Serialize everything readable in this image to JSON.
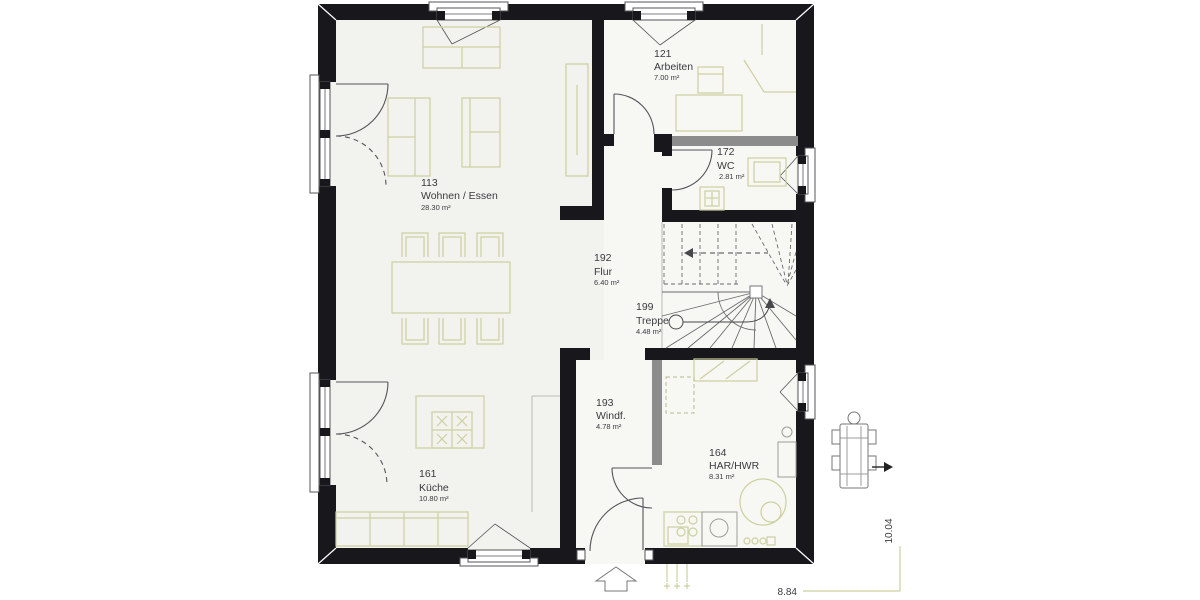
{
  "rooms": [
    {
      "number": "113",
      "name": "Wohnen / Essen",
      "area": "28.30 m²"
    },
    {
      "number": "121",
      "name": "Arbeiten",
      "area": "7.00 m²"
    },
    {
      "number": "172",
      "name": "WC",
      "area": "2.81 m²"
    },
    {
      "number": "192",
      "name": "Flur",
      "area": "6.40 m²"
    },
    {
      "number": "199",
      "name": "Treppe",
      "area": "4.48 m²"
    },
    {
      "number": "193",
      "name": "Windf.",
      "area": "4.78 m²"
    },
    {
      "number": "161",
      "name": "Küche",
      "area": "10.80 m²"
    },
    {
      "number": "164",
      "name": "HAR/HWR",
      "area": "8.31 m²"
    }
  ],
  "dimensions": {
    "width": "8.84",
    "height": "10.04"
  },
  "colors": {
    "wall": "#17171c",
    "partition_wall": "#8c8c8c",
    "fixture_green": "#ccd19e",
    "dimension_green": "#c9cf9d",
    "floor": "#f2f2ee",
    "text": "#3b3b40"
  }
}
